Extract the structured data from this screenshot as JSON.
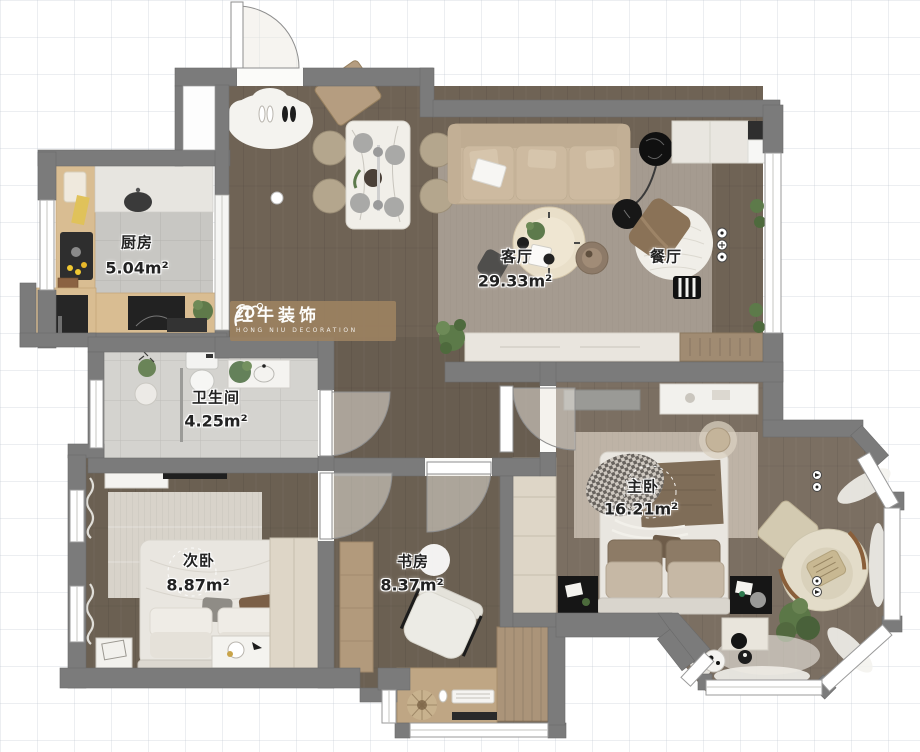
{
  "watermark": {
    "brand": "红牛装饰",
    "subtitle": "HONG NIU DECORATION"
  },
  "rooms": {
    "kitchen": {
      "name": "厨房",
      "area": "5.04m²"
    },
    "living_room": {
      "name": "客厅",
      "area": "29.33m²"
    },
    "dining_room": {
      "name": "餐厅"
    },
    "bathroom": {
      "name": "卫生间",
      "area": "4.25m²"
    },
    "secondary_bedroom": {
      "name": "次卧",
      "area": "8.87m²"
    },
    "study": {
      "name": "书房",
      "area": "8.37m²"
    },
    "master_bedroom": {
      "name": "主卧",
      "area": "16.21m²"
    }
  },
  "colors": {
    "wall": "#7b7b7b",
    "wood_floor": "#6f6355",
    "tile_floor": "#cac9c5",
    "sofa": "#c9b69c",
    "accent_black": "#161616"
  }
}
